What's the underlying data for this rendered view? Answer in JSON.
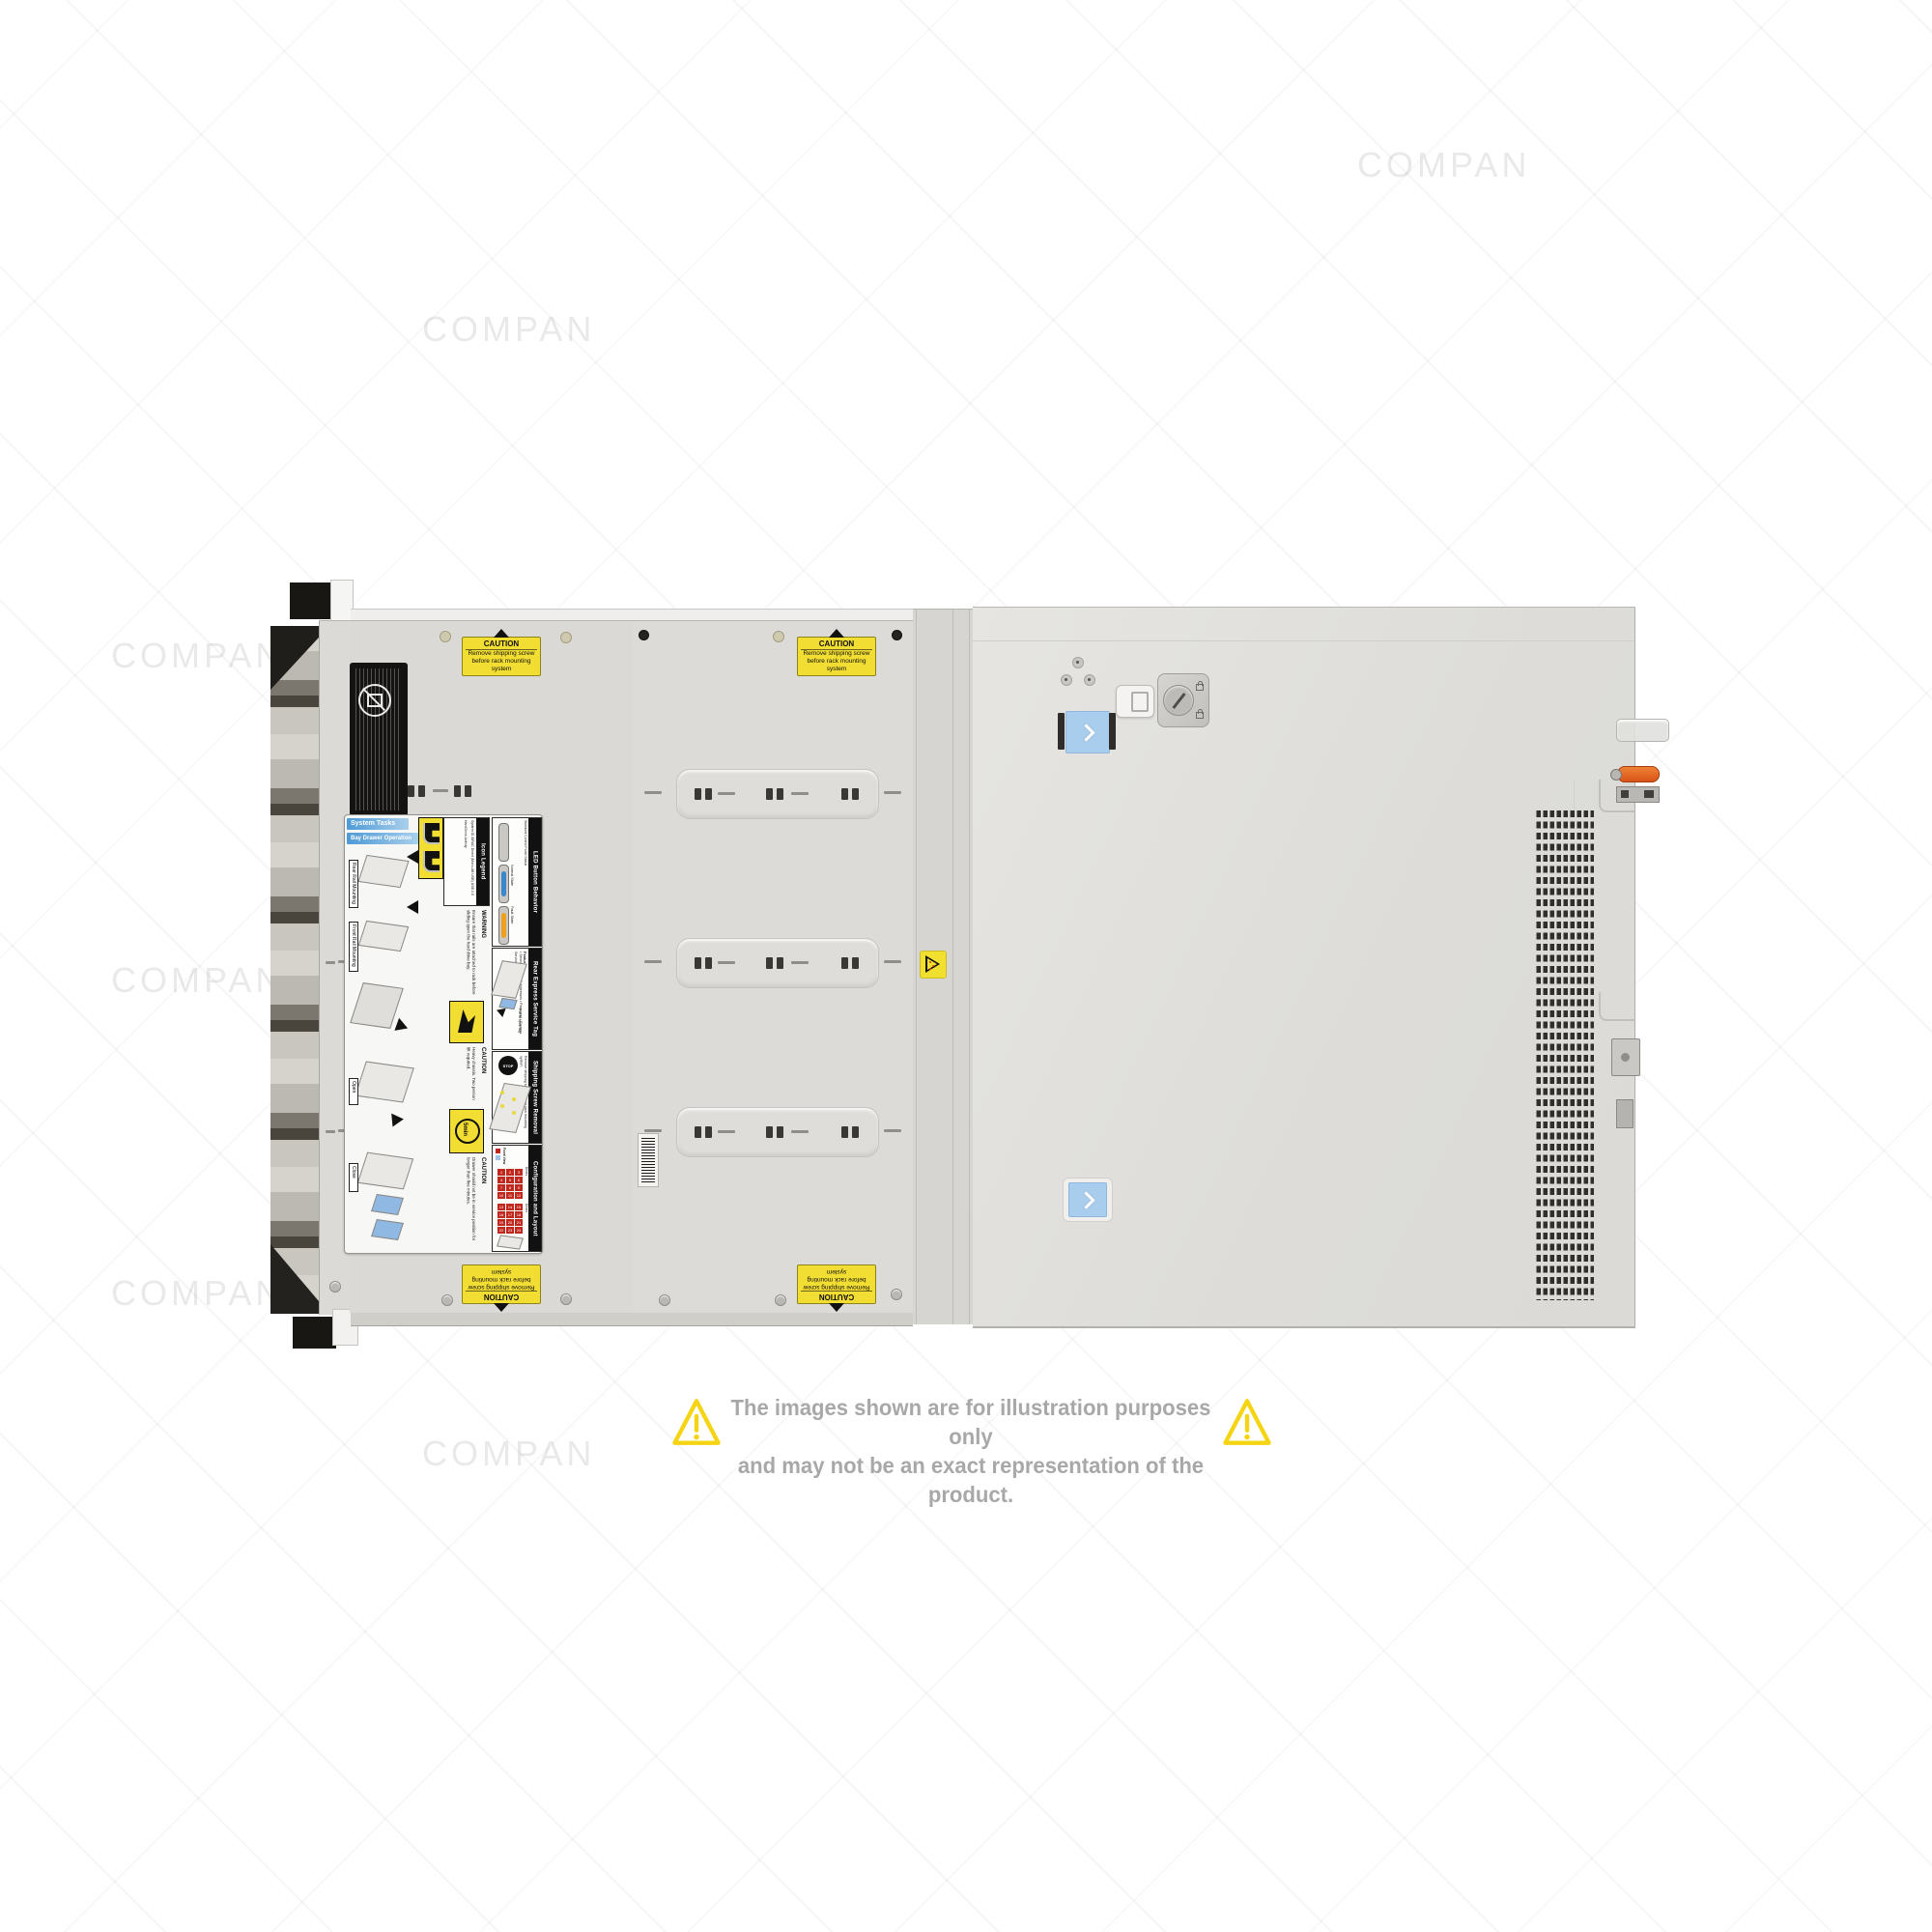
{
  "watermark": {
    "text": "COMPAN"
  },
  "disclaimer": {
    "line1": "The images shown are for illustration purposes only",
    "line2": "and may not be an exact representation of the product.",
    "text_color": "#a8a8a8",
    "triangle_color": "#f5d413"
  },
  "caution_sticker": {
    "title": "CAUTION",
    "line1": "Remove shipping screw",
    "line2": "before rack mounting system"
  },
  "service_label": {
    "system_tasks": "System Tasks",
    "bay_drawer": "Bay Drawer Operation",
    "steps": [
      "Rear Rail Mounting",
      "Front Rail Mounting",
      "Open",
      "Close"
    ],
    "warning_title": "WARNING",
    "warning_text": "Ensure that rails are attached to rack before sliding open the hard drive bay.",
    "caution1_title": "CAUTION",
    "caution1_text": "Heavy chassis. Two person lift required.",
    "caution2_title": "CAUTION",
    "caution2_text": "Drawer should not be in service position for longer than five minutes.",
    "five_min": "5min",
    "icon_legend": {
      "title": "Icon Legend",
      "items": [
        "System ID",
        "iDRAC Direct (Micro-AB USB)",
        "USB 2.0",
        "Hard Drive Activity"
      ]
    },
    "led_behavior": {
      "title": "LED Button Behavior",
      "subtitle": "Standard Control Panel Status",
      "normal": "Normal State",
      "fault": "Fault State",
      "normal_color": "#3a87ce",
      "fault_color": "#f0a11c"
    },
    "service_tag": {
      "title": "Rear Express Service Tag",
      "features_title": "Features:",
      "features": [
        "Service Tag",
        "MAC Addresses",
        "Password",
        "Express Service Code"
      ],
      "note": "Pull to open tag"
    },
    "shipping": {
      "title": "Shipping Screw Removal",
      "stop": "STOP",
      "text": "Remove shipping screws before rack mounting system."
    },
    "config": {
      "title": "Configuration and Layout",
      "legend_hot": "Hot Swap Touchpoints (removable)",
      "legend_cold": "Cold Swap Touchpoints (fixed)",
      "front_view": "Front View",
      "bay1": "Bay 1: 3.5\" x12 Hard Drives",
      "bay2": "Bay 2: 3.5\" x12 Hard Drives",
      "bay1_drives": [
        "1",
        "2",
        "3",
        "4",
        "5",
        "6",
        "7",
        "8",
        "9",
        "10",
        "11",
        "12"
      ],
      "bay2_drives": [
        "13",
        "14",
        "15",
        "16",
        "17",
        "18",
        "19",
        "20",
        "21",
        "22",
        "23",
        "24"
      ],
      "hot_color": "#c1271d",
      "cold_color": "#9fc4e8"
    }
  }
}
